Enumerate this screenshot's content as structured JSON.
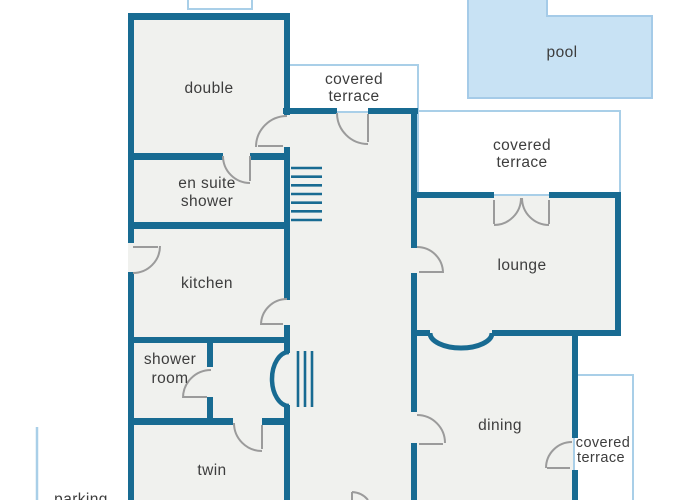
{
  "plan": {
    "type": "floor-plan",
    "colors": {
      "background": "#ffffff",
      "wall": "#186b92",
      "room_fill": "#f0f1ee",
      "terrace_border": "#a9cfe8",
      "pool_fill": "#c8e2f4",
      "pool_border": "#a5cbe8",
      "door_arc": "#9b9b9b",
      "label_text": "#3d3d3d"
    },
    "rooms": {
      "double": {
        "label": "double"
      },
      "en_suite_shower": {
        "label_line1": "en suite",
        "label_line2": "shower"
      },
      "kitchen": {
        "label": "kitchen"
      },
      "shower_room": {
        "label_line1": "shower",
        "label_line2": "room"
      },
      "twin": {
        "label": "twin"
      },
      "lounge": {
        "label": "lounge"
      },
      "dining": {
        "label": "dining"
      }
    },
    "outdoor": {
      "pool": {
        "label": "pool"
      },
      "covered_terrace_top": {
        "label_line1": "covered",
        "label_line2": "terrace"
      },
      "covered_terrace_right": {
        "label_line1": "covered",
        "label_line2": "terrace"
      },
      "covered_terrace_bottom_right": {
        "label_line1": "covered",
        "label_line2": "terrace"
      },
      "parking": {
        "label": "parking"
      }
    }
  }
}
